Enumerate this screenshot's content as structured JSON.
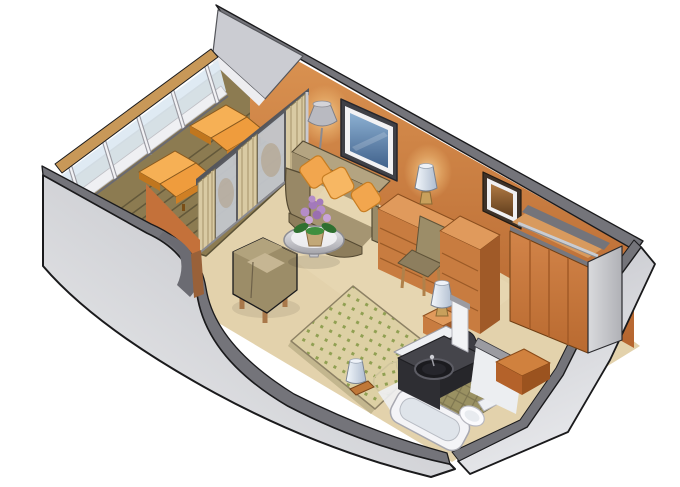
{
  "scene": {
    "type": "isometric-cutaway-floor-plan",
    "subject": "stateroom-with-private-balcony",
    "width": 680,
    "height": 487,
    "areas": [
      "balcony",
      "living-area",
      "bedroom",
      "bathroom",
      "entry",
      "closet"
    ],
    "objects": [
      "balcony-railing",
      "balcony-deck",
      "lounge-chair",
      "lounge-chair",
      "sliding-glass-door",
      "curtains",
      "floor-lamp",
      "sofa",
      "throw-pillows",
      "wall-tv",
      "coffee-table",
      "flower-vase",
      "armchair",
      "desk-dresser",
      "desk-chair",
      "table-lamp",
      "wall-mirror",
      "tall-chest",
      "wardrobe-closet",
      "clothes-rail",
      "bed",
      "bed-pillows",
      "nightstand",
      "bedside-lamp",
      "bathroom-vanity",
      "round-sink",
      "bathtub",
      "toilet",
      "side-cabinet"
    ]
  },
  "palette": {
    "background": "#ffffff",
    "wall_cap": "#74747a",
    "wall_exterior": "#c7c8ce",
    "wall_orange": "#c4713a",
    "floor": "#e3d2ac",
    "deck": "#8c7b51",
    "rail_wood": "#c89858",
    "rail_glass": "#dce8f2",
    "curtain": "#d9caa3",
    "door_glass": "#c3c7cd",
    "sofa": "#a59572",
    "pillow": "#f2a64e",
    "lounge": "#ef9c3d",
    "wood": "#c87c40",
    "wood_light": "#e09a5c",
    "wood_dark": "#a05a28",
    "chair_olive": "#9c8d68",
    "chair_cushion": "#c6b693",
    "bed_base": "#ddd0a4",
    "bed_dot": "#90a052",
    "vanity": "#45454b",
    "tile": "#9a9162",
    "fixture_white": "#f4f4f7",
    "flower": "#b48cc8",
    "leaf": "#2f7030"
  }
}
